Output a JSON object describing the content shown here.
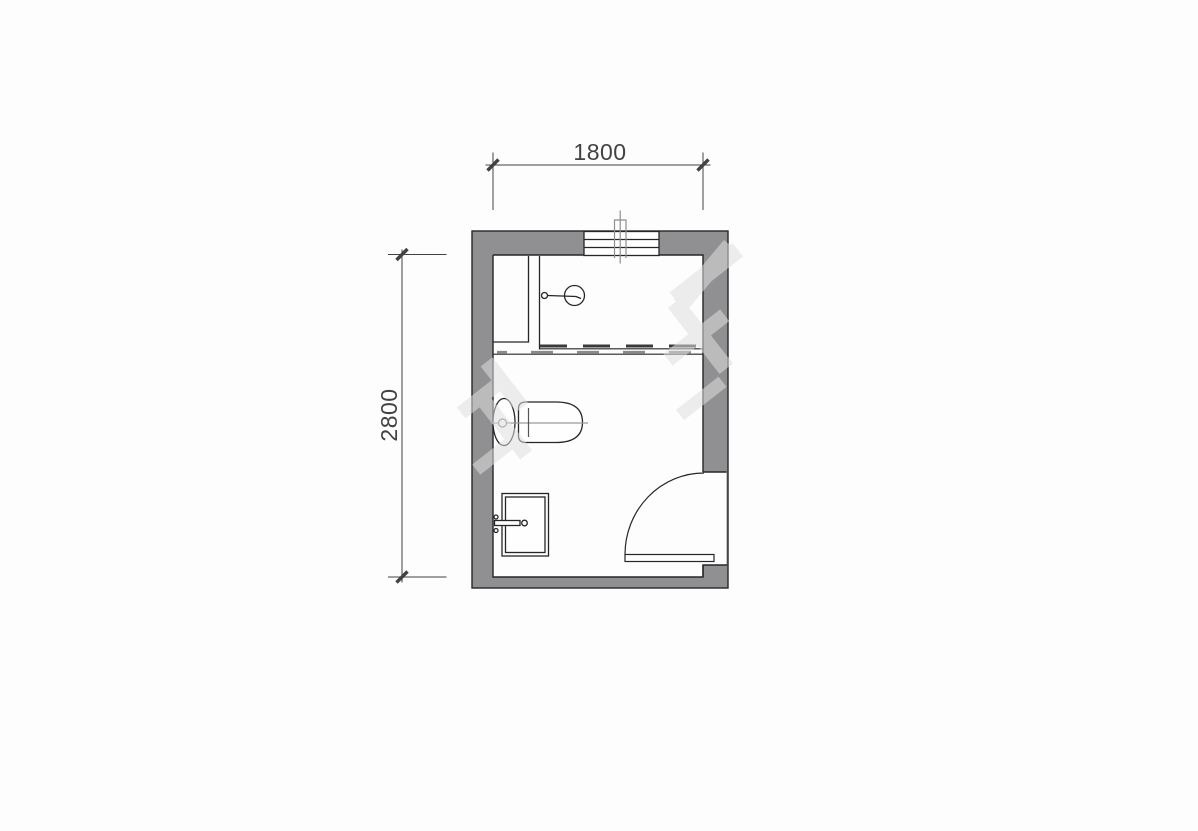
{
  "drawing": {
    "type": "bathroom-floor-plan",
    "dimensions": {
      "top": {
        "label": "1800",
        "value_mm": 1800
      },
      "left": {
        "label": "2800",
        "value_mm": 2800
      }
    },
    "fixtures": [
      "window",
      "vent-pipe",
      "service-duct",
      "shower-head",
      "shower-screen-track",
      "toilet",
      "wash-basin",
      "door"
    ]
  },
  "colors": {
    "background": "#fdfdfd",
    "wall_fill": "#909092",
    "line": "#262626",
    "dim": "#424242",
    "soft_gray": "#8f8f8f",
    "centerline": "#9a9a9a",
    "dash_dark": "#3a3a3a",
    "dash_light": "#8a8a8a",
    "watermark": "#dedede"
  }
}
